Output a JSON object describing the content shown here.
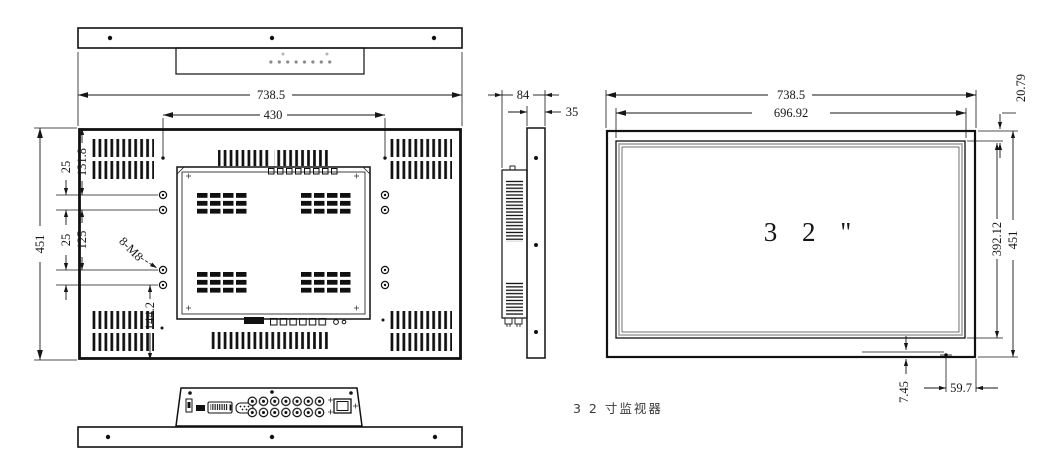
{
  "caption": "3 2 寸监视器",
  "rear_view": {
    "width_total": "738.5",
    "mount_width": "430",
    "height_total": "451",
    "top_to_hole": "131.8",
    "hole_gap_top": "25",
    "mount_height": "125",
    "hole_gap_bottom": "25",
    "hole_to_bottom": "144.2",
    "mount_holes_label": "8-M8"
  },
  "side_view": {
    "depth_total": "84",
    "front_depth": "35"
  },
  "front_view": {
    "width_total": "738.5",
    "screen_width": "696.92",
    "top_bezel": "20.79",
    "screen_height": "392.12",
    "height_total": "451",
    "button_bottom_offset": "7.45",
    "button_right_offset": "59.7",
    "screen_size": "3 2 \""
  }
}
